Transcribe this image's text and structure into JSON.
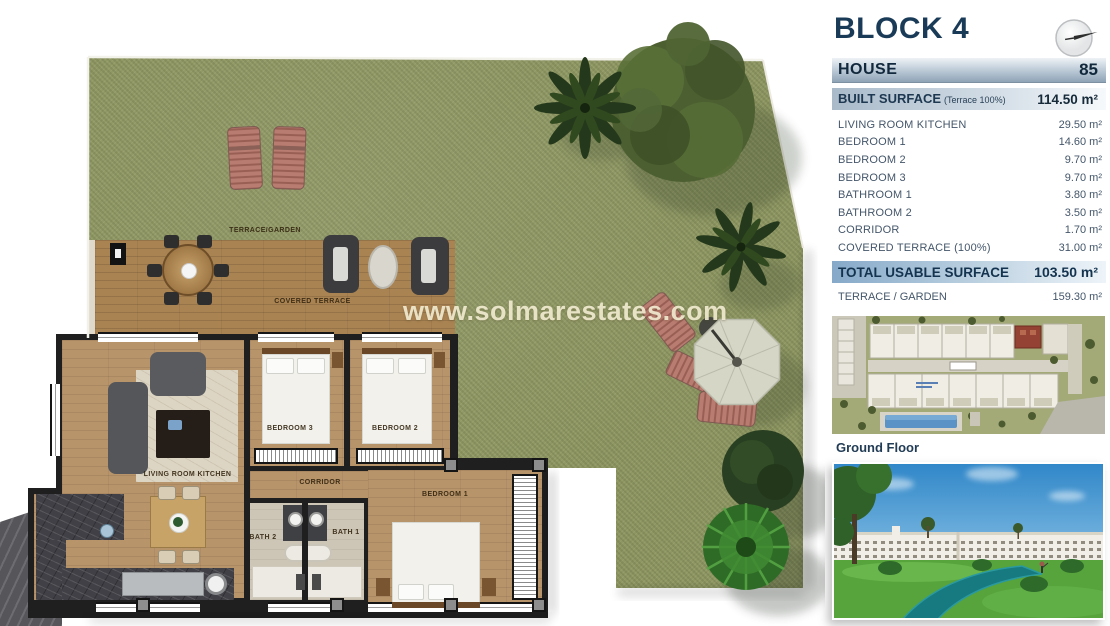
{
  "watermark": {
    "text": "www.solmarestates.com"
  },
  "sidebar": {
    "block_title": "BLOCK 4",
    "house": {
      "label": "HOUSE",
      "number": "85"
    },
    "built_surface": {
      "label": "BUILT SURFACE",
      "note": "(Terrace 100%)",
      "value": "114.50 m²"
    },
    "rooms": [
      {
        "label": "LIVING ROOM KITCHEN",
        "value": "29.50 m²"
      },
      {
        "label": "BEDROOM 1",
        "value": "14.60 m²"
      },
      {
        "label": "BEDROOM 2",
        "value": "9.70 m²"
      },
      {
        "label": "BEDROOM 3",
        "value": "9.70 m²"
      },
      {
        "label": "BATHROOM 1",
        "value": "3.80 m²"
      },
      {
        "label": "BATHROOM 2",
        "value": "3.50 m²"
      },
      {
        "label": "CORRIDOR",
        "value": "1.70 m²"
      },
      {
        "label": "COVERED TERRACE (100%)",
        "value": "31.00 m²"
      }
    ],
    "total": {
      "label": "TOTAL USABLE SURFACE",
      "value": "103.50 m²"
    },
    "terrace_garden": {
      "label": "TERRACE / GARDEN",
      "value": "159.30 m²"
    },
    "site_plan_caption": "Ground Floor"
  },
  "plan": {
    "labels": {
      "terrace_garden": "TERRACE/GARDEN",
      "covered_terrace": "COVERED TERRACE",
      "living": "LIVING ROOM KITCHEN",
      "bedroom1": "BEDROOM 1",
      "bedroom2": "BEDROOM 2",
      "bedroom3": "BEDROOM 3",
      "corridor": "CORRIDOR",
      "bath1": "BATH 1",
      "bath2": "BATH 2"
    }
  },
  "colors": {
    "accent_navy": "#1a3b58",
    "grass": "#8e9663",
    "deck_wood": "#aa8353",
    "floor_wood": "#b8946a",
    "highlight_unit": "#944233",
    "pool_blue": "#5c93c6",
    "water_teal": "#177a80",
    "lounger_pink": "#b97c70"
  }
}
